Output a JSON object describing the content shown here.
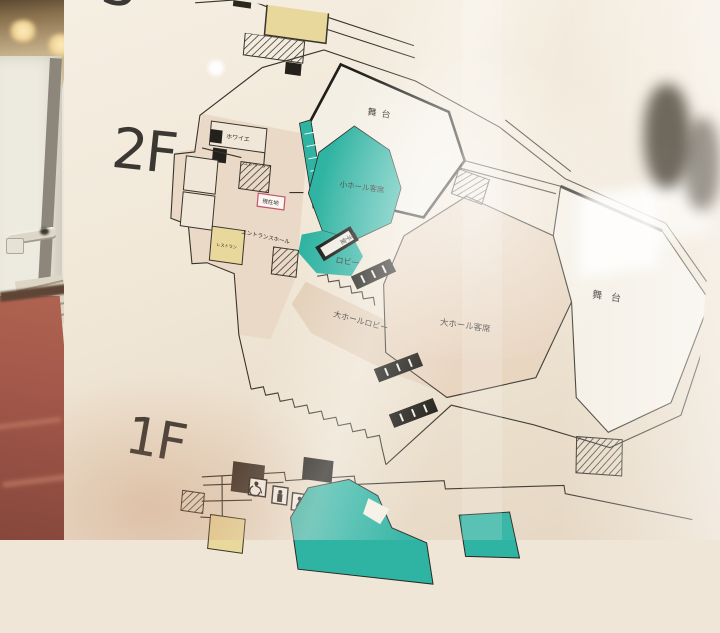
{
  "scene": {
    "description": "Photograph of a building floor-guide map sign behind reflective glass, viewed at an angle from a corridor",
    "left_view": "corridor with handrail, stairs and red-brown floor"
  },
  "sign": {
    "floor_labels": {
      "third_partial": "3",
      "second": "2F",
      "first": "1F"
    },
    "plan_2f": {
      "labels": {
        "small_hall_stage": "舞台",
        "small_hall_seating": "小ホール客席",
        "lobby": "ロビー",
        "mother_child_room": "母子室",
        "foyer": "ホワイエ",
        "elevator": "エレベーター",
        "entrance_hall": "エントランスホール",
        "restaurant": "レストラン",
        "you_are_here": "現在地",
        "large_hall_lobby": "大ホールロビー",
        "large_hall_seating": "大ホール客席",
        "large_hall_stage": "舞台"
      }
    },
    "plan_1f": {
      "icons": [
        "wheelchair-icon",
        "restroom-person-icon",
        "restroom-person-icon",
        "elevator-icon"
      ]
    },
    "colors": {
      "hall_teal": "#2fb3a2",
      "seat_beige": "#e7d3bd",
      "lobby_beige": "#e3cfb8",
      "room_yellow": "#e9d89c",
      "room_dark_brown": "#40342b",
      "line_dark": "#38342c",
      "you_are_here_red": "#c0566a",
      "sign_cream": "#f0e7d9"
    }
  }
}
